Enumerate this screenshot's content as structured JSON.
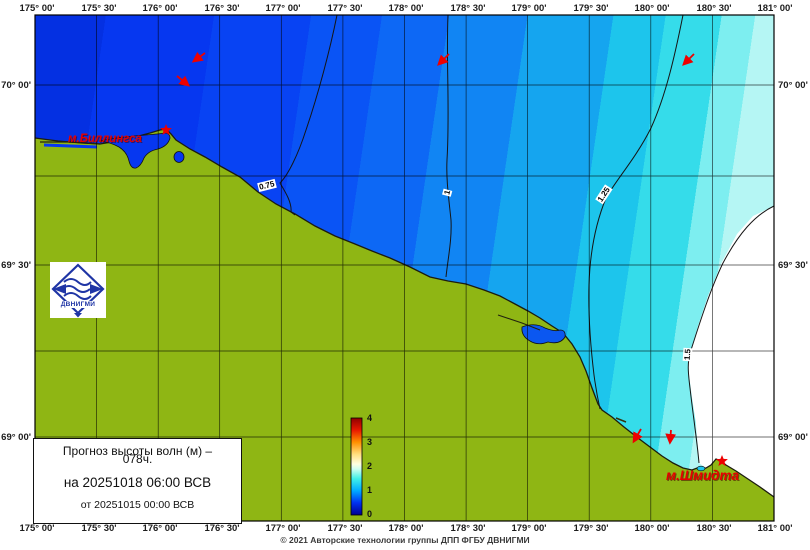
{
  "forecast_box": {
    "title_line1": "Прогноз высоты волн (м) –",
    "title_line2": "078ч.",
    "valid_line": "на 20251018 06:00 ВСВ",
    "issued_line": "от 20251015 00:00 ВСВ"
  },
  "copyright": "© 2021 Авторские технологии группы ДПП ФГБУ ДВНИГМИ",
  "logo": {
    "text": "ДВНИГМИ"
  },
  "places": [
    {
      "label": "м.Биллингса"
    },
    {
      "label": "м.Шмидта"
    }
  ],
  "contour_labels": [
    "0.75",
    "1",
    "1.25",
    "1.5"
  ],
  "colorbar": {
    "ticks": [
      "4",
      "3",
      "2",
      "1",
      "0"
    ]
  },
  "axes": {
    "top": [
      "175° 00'",
      "175° 30'",
      "176° 00'",
      "176° 30'",
      "177° 00'",
      "177° 30'",
      "178° 00'",
      "178° 30'",
      "179° 00'",
      "179° 30'",
      "180° 00'",
      "180° 30'",
      "181° 00'"
    ],
    "bottom": [
      "175° 00'",
      "175° 30'",
      "176° 00'",
      "176° 30'",
      "177° 00'",
      "177° 30'",
      "178° 00'",
      "178° 30'",
      "179° 00'",
      "179° 30'",
      "180° 00'",
      "180° 30'",
      "181° 00'"
    ],
    "left": [
      "70° 00'",
      "69° 30'",
      "69° 00'"
    ],
    "right": [
      "70° 00'",
      "69° 30'",
      "69° 00'"
    ]
  },
  "colors": {
    "land": "#8fb614",
    "sea_deep": "#0430e2",
    "sea_light": "#b5f6f4",
    "accent_red": "#ee0000",
    "logo_blue": "#1f35a5"
  },
  "chart_data": {
    "type": "contour-map",
    "quantity": "Высота волн (м) / wave height",
    "contour_levels_m": [
      0.75,
      1,
      1.25,
      1.5
    ],
    "colorbar_range_m": [
      0,
      4
    ],
    "colorbar_ticks": [
      0,
      1,
      2,
      3,
      4
    ],
    "forecast_hour": "078",
    "valid_time": "20251018 06:00 ВСВ",
    "base_time": "20251015 00:00 ВСВ",
    "lon_ticks": [
      "175° 00'",
      "175° 30'",
      "176° 00'",
      "176° 30'",
      "177° 00'",
      "177° 30'",
      "178° 00'",
      "178° 30'",
      "179° 00'",
      "179° 30'",
      "180° 00'",
      "180° 30'",
      "181° 00'"
    ],
    "lat_ticks": [
      "70° 00'",
      "69° 30'",
      "69° 00'"
    ],
    "wave_direction_arrows": 6,
    "capes_marked": [
      "м.Биллингса",
      "м.Шмидта"
    ]
  }
}
